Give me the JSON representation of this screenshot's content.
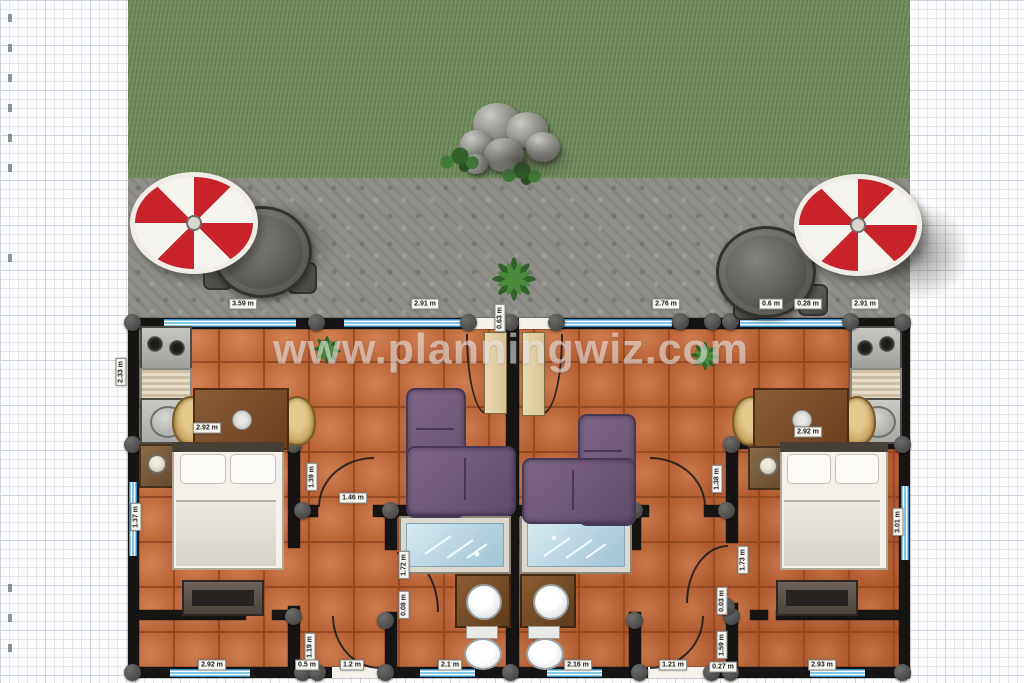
{
  "watermark": "www.planningwiz.com",
  "colors": {
    "grass": "#7a9463",
    "pavement": "#8f8e88",
    "floor_tile": "#c2683a",
    "wall": "#161514",
    "window_blue": "#2e8fc9",
    "umbrella_red": "#c8232a",
    "sofa_purple": "#6d5677",
    "bathtub_blue": "#aecfdd",
    "label_bg": "#f7f5ef"
  },
  "labels": [
    {
      "text": "3.59 m",
      "x": 243,
      "y": 304,
      "rot": false
    },
    {
      "text": "2.91 m",
      "x": 425,
      "y": 304,
      "rot": false
    },
    {
      "text": "0.63 m",
      "x": 500,
      "y": 318,
      "rot": true
    },
    {
      "text": "2.76 m",
      "x": 666,
      "y": 304,
      "rot": false
    },
    {
      "text": "0.6 m",
      "x": 771,
      "y": 304,
      "rot": false
    },
    {
      "text": "0.28 m",
      "x": 808,
      "y": 304,
      "rot": false
    },
    {
      "text": "2.91 m",
      "x": 865,
      "y": 304,
      "rot": false
    },
    {
      "text": "2.33 m",
      "x": 121,
      "y": 372,
      "rot": true
    },
    {
      "text": "1.37 m",
      "x": 136,
      "y": 517,
      "rot": true
    },
    {
      "text": "3.01 m",
      "x": 898,
      "y": 522,
      "rot": true
    },
    {
      "text": "2.92 m",
      "x": 207,
      "y": 428,
      "rot": false
    },
    {
      "text": "2.92 m",
      "x": 808,
      "y": 432,
      "rot": false
    },
    {
      "text": "1.39 m",
      "x": 312,
      "y": 477,
      "rot": true
    },
    {
      "text": "1.46 m",
      "x": 353,
      "y": 498,
      "rot": false
    },
    {
      "text": "1.38 m",
      "x": 717,
      "y": 479,
      "rot": true
    },
    {
      "text": "1.72 m",
      "x": 404,
      "y": 565,
      "rot": true
    },
    {
      "text": "0.08 m",
      "x": 404,
      "y": 605,
      "rot": true
    },
    {
      "text": "1.73 m",
      "x": 743,
      "y": 560,
      "rot": true
    },
    {
      "text": "0.03 m",
      "x": 722,
      "y": 601,
      "rot": true
    },
    {
      "text": "1.59 m",
      "x": 722,
      "y": 645,
      "rot": true
    },
    {
      "text": "1.19 m",
      "x": 310,
      "y": 647,
      "rot": true
    },
    {
      "text": "2.92 m",
      "x": 212,
      "y": 665,
      "rot": false
    },
    {
      "text": "0.5 m",
      "x": 307,
      "y": 665,
      "rot": false
    },
    {
      "text": "1.2 m",
      "x": 352,
      "y": 665,
      "rot": false
    },
    {
      "text": "2.1 m",
      "x": 450,
      "y": 665,
      "rot": false
    },
    {
      "text": "2.16 m",
      "x": 578,
      "y": 665,
      "rot": false
    },
    {
      "text": "1.21 m",
      "x": 673,
      "y": 665,
      "rot": false
    },
    {
      "text": "0.27 m",
      "x": 723,
      "y": 667,
      "rot": false
    },
    {
      "text": "2.93 m",
      "x": 822,
      "y": 665,
      "rot": false
    }
  ],
  "objects": [
    "parasol-left",
    "parasol-right",
    "patio-table-left",
    "patio-table-right",
    "rock-cluster",
    "agave-plant",
    "houseplant-left",
    "houseplant-right",
    "kitchen-left",
    "kitchen-right",
    "dining-set-left",
    "dining-set-right",
    "bed-left",
    "bed-right",
    "nightstand-left",
    "nightstand-right",
    "dresser-left",
    "dresser-right",
    "sofa-left",
    "sofa-right",
    "bathtub-left",
    "bathtub-right",
    "vanity-left",
    "vanity-right",
    "toilet-left",
    "toilet-right"
  ]
}
